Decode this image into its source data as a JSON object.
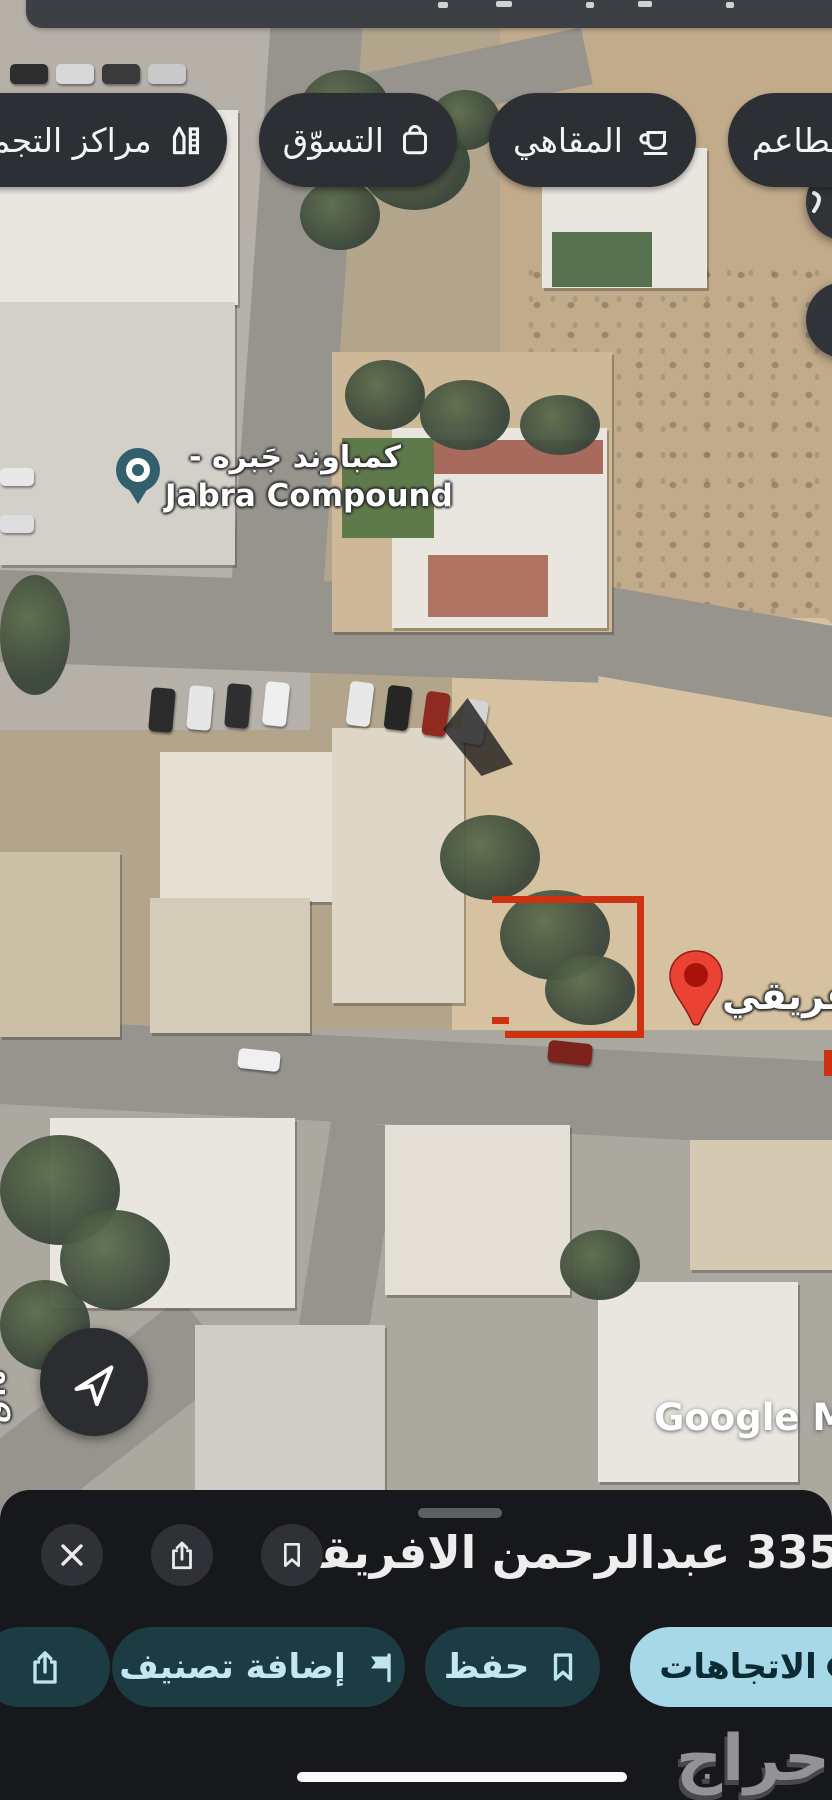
{
  "top": {
    "chips": [
      {
        "label": "المطاعم",
        "icon": "restaurant-icon"
      },
      {
        "label": "المقاهي",
        "icon": "coffee-cup-icon"
      },
      {
        "label": "التسوّق",
        "icon": "shopping-bag-icon"
      },
      {
        "label": "مراكز التجميل",
        "icon": "cosmetics-icon"
      }
    ]
  },
  "map": {
    "view": "satellite",
    "compound_label_ar": "كمباوند جَبره -",
    "compound_label_en": "Jabra Compound",
    "destination_label": "الافريقي",
    "edge_street_fragment": "١٥ق",
    "google_watermark": "Google Ma",
    "plot_outline_color": "#cf3210",
    "destination_pin_color": "#ea4335",
    "compound_pin_color": "#315f6b"
  },
  "sheet": {
    "title": "335 عبدالرحمن الافريقي",
    "actions": {
      "directions": "الاتجاهات",
      "save": "حفظ",
      "add_label": "إضافة تصنيف"
    },
    "colors": {
      "primary_pill": "#a6d8e7",
      "pill_dark": "#1c3b43",
      "pill_text": "#c3e7f3"
    },
    "watermark": "حراج"
  }
}
